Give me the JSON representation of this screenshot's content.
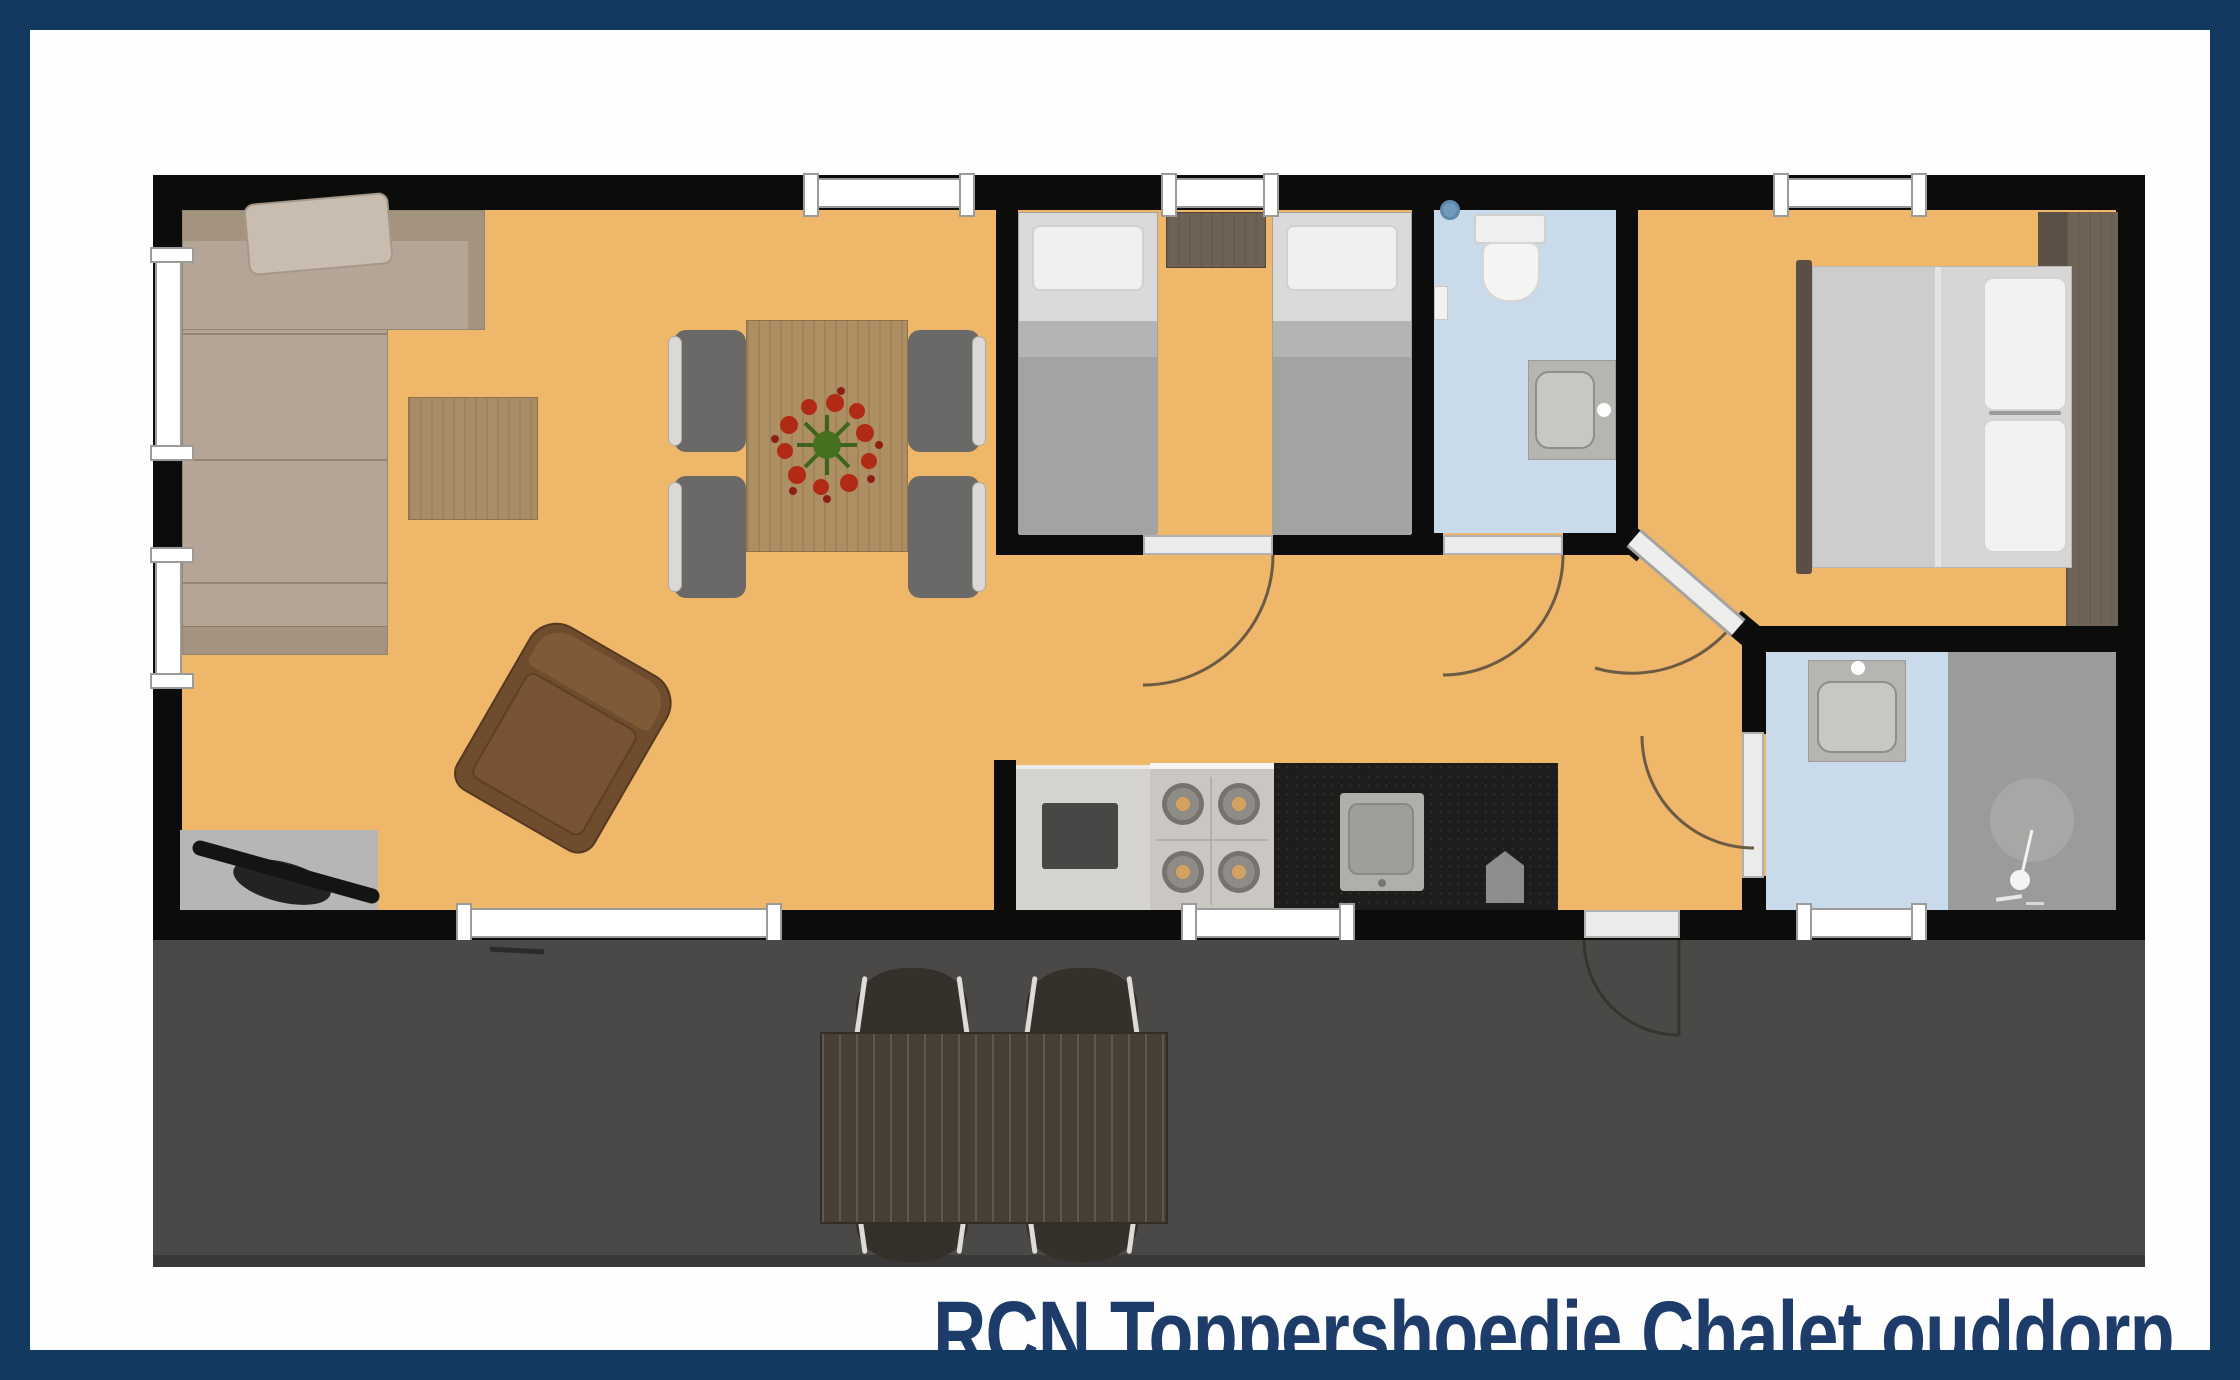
{
  "title": {
    "text": "RCN Toppershoedje Chalet ouddorp",
    "color": "#1d3c6a"
  },
  "frame": {
    "border_color": "#12395f",
    "background": "#ffffff"
  },
  "palette": {
    "wall": "#0c0c0a",
    "floor_main": "#eeb76a",
    "floor_bathroom": "#c9daea",
    "floor_shower": "#9b9b99",
    "terrace": "#4a4947",
    "window": "#ffffff",
    "door_leaf": "#ebebe9",
    "door_arc": "#6b5b45",
    "sofa": "#b4a597",
    "bed_blanket": "#a5a3a1",
    "wood_table": "#ad8f63",
    "outdoor_wood": "#473f36"
  },
  "rooms": [
    {
      "name": "living-dining-room",
      "floor": "#eeb76a"
    },
    {
      "name": "twin-bedroom",
      "floor": "#eeb76a"
    },
    {
      "name": "bathroom-wc",
      "floor": "#c9daea"
    },
    {
      "name": "double-bedroom",
      "floor": "#eeb76a"
    },
    {
      "name": "shower-room",
      "floor": "#c9daea"
    },
    {
      "name": "kitchen",
      "floor": "#eeb76a"
    },
    {
      "name": "terrace",
      "floor": "#4a4947"
    }
  ],
  "furniture": [
    "corner-sofa",
    "sofa-pillow",
    "coffee-table",
    "armchair",
    "tv-on-mat",
    "dining-table",
    "dining-chair x4",
    "flower-centerpiece",
    "twin-bed x2",
    "nightstand",
    "toilet",
    "washbasin x2",
    "double-bed",
    "wardrobe-strip",
    "kitchen-counter",
    "gas-hob",
    "kitchen-sink",
    "shower",
    "outdoor-table",
    "outdoor-chair x4"
  ],
  "window_count": 8,
  "door_count": 5
}
